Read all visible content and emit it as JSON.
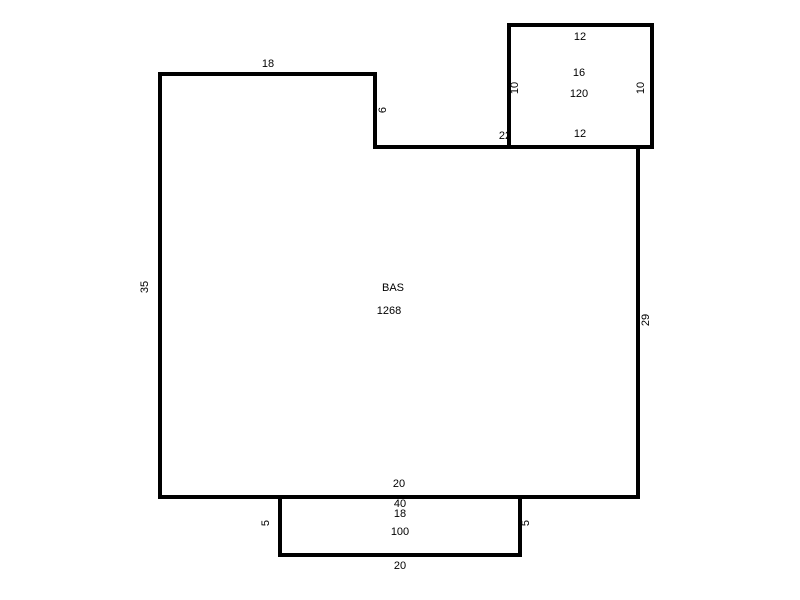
{
  "floor_plan": {
    "main_room": {
      "name": "BAS",
      "area": "1268",
      "top_width": "18",
      "notch_height": "6",
      "left_height": "35",
      "right_height": "29",
      "junction_dim": "22",
      "bottom_inner_width": "20"
    },
    "top_right_room": {
      "top_width": "12",
      "bottom_width": "12",
      "left_height": "10",
      "right_height": "10",
      "dim": "16",
      "area": "120"
    },
    "bottom_room": {
      "upper_dim": "40",
      "inner_dim": "18",
      "area": "100",
      "left_height": "5",
      "right_height": "5",
      "bottom_width": "20"
    },
    "colors": {
      "line": "#000000",
      "background": "#ffffff",
      "text": "#000000"
    }
  }
}
